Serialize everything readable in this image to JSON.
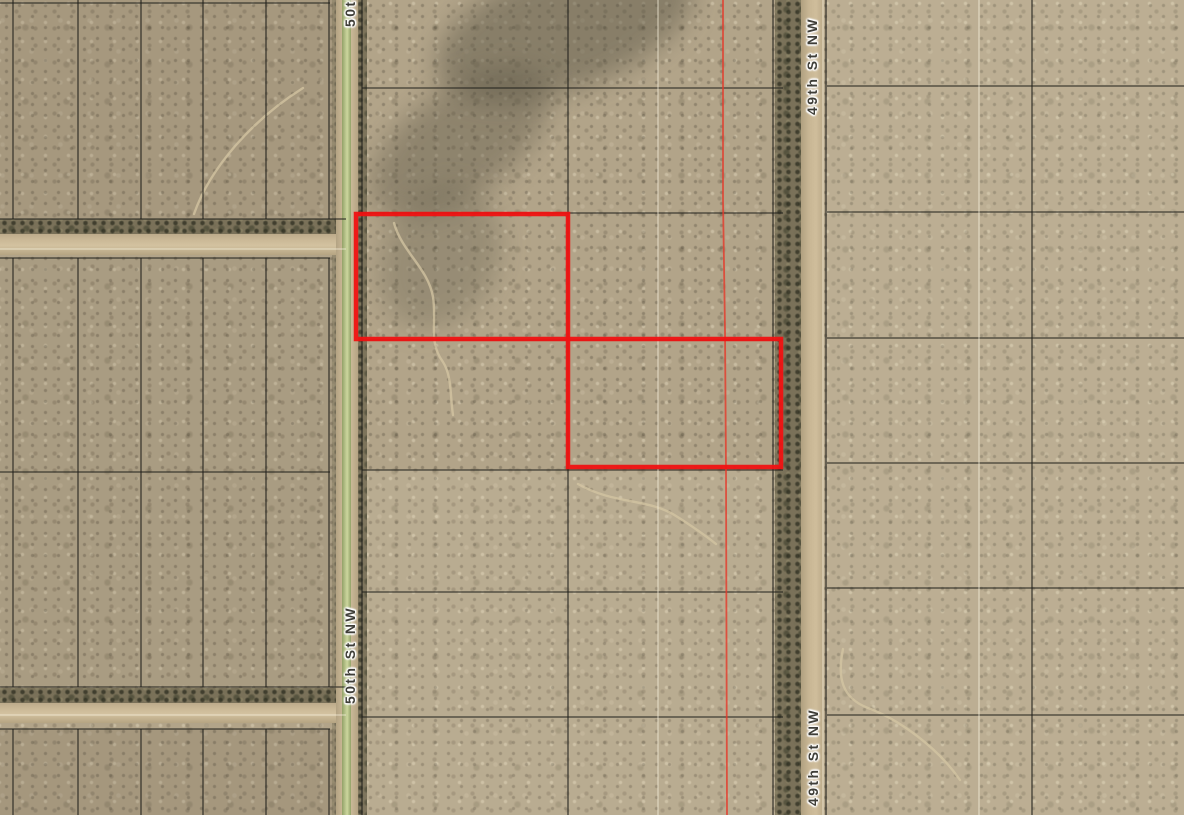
{
  "map": {
    "street_labels": [
      {
        "id": "lbl-50th-top",
        "text": "50th St NW",
        "note": "partially cut off at top edge of view"
      },
      {
        "id": "lbl-50th",
        "text": "50th St NW"
      },
      {
        "id": "lbl-49th-top",
        "text": "49th St NW"
      },
      {
        "id": "lbl-49th-bot",
        "text": "49th St NW"
      }
    ],
    "highlighted_parcels": [
      {
        "id": "parcel-highlight-northwest",
        "x": 356,
        "y": 214,
        "width": 212,
        "height": 125
      },
      {
        "id": "parcel-highlight-southeast",
        "x": 568,
        "y": 339,
        "width": 213,
        "height": 128
      }
    ],
    "colors": {
      "terrain_tan": "#b2a489",
      "road_dirt": "#cfbe9d",
      "street_centerline_green": "#c0cc93",
      "vegetation_dark": "#746c54",
      "parcel_line_black": "#21201c",
      "survey_line_white": "#f6f0dc",
      "highlight_red": "#f01212",
      "section_line_red": "#e5392a",
      "label_text": "#3f3e38"
    },
    "geometry": {
      "black_segments": [
        [
          13,
          0,
          13,
          219
        ],
        [
          78,
          0,
          78,
          219
        ],
        [
          141,
          0,
          141,
          219
        ],
        [
          203,
          0,
          203,
          219
        ],
        [
          266,
          0,
          266,
          219
        ],
        [
          329,
          0,
          329,
          219
        ],
        [
          13,
          258,
          13,
          687
        ],
        [
          78,
          258,
          78,
          687
        ],
        [
          141,
          258,
          141,
          687
        ],
        [
          203,
          258,
          203,
          687
        ],
        [
          266,
          258,
          266,
          687
        ],
        [
          329,
          258,
          329,
          687
        ],
        [
          13,
          729,
          13,
          815
        ],
        [
          78,
          729,
          78,
          815
        ],
        [
          141,
          729,
          141,
          815
        ],
        [
          203,
          729,
          203,
          815
        ],
        [
          266,
          729,
          266,
          815
        ],
        [
          329,
          729,
          329,
          815
        ],
        [
          0,
          3,
          330,
          3
        ],
        [
          0,
          219,
          346,
          219
        ],
        [
          0,
          258,
          330,
          258
        ],
        [
          0,
          472,
          330,
          472
        ],
        [
          0,
          687,
          346,
          687
        ],
        [
          0,
          729,
          330,
          729
        ],
        [
          568,
          0,
          568,
          815
        ],
        [
          362,
          0,
          362,
          815
        ],
        [
          773,
          0,
          773,
          815
        ],
        [
          362,
          88,
          783,
          88
        ],
        [
          362,
          213,
          783,
          213
        ],
        [
          362,
          340,
          783,
          340
        ],
        [
          362,
          470,
          783,
          470
        ],
        [
          362,
          592,
          783,
          592
        ],
        [
          362,
          717,
          783,
          717
        ],
        [
          826,
          0,
          826,
          815
        ],
        [
          1032,
          0,
          1032,
          815
        ],
        [
          827,
          86,
          1184,
          86
        ],
        [
          827,
          212,
          1184,
          212
        ],
        [
          827,
          338,
          1184,
          338
        ],
        [
          827,
          463,
          1184,
          463
        ],
        [
          827,
          588,
          1184,
          588
        ],
        [
          827,
          715,
          1184,
          715
        ]
      ],
      "white_segments": [
        [
          658,
          0,
          658,
          815
        ],
        [
          979,
          0,
          979,
          815
        ],
        [
          823,
          0,
          823,
          815
        ],
        [
          0,
          249,
          346,
          249
        ],
        [
          0,
          715,
          346,
          715
        ]
      ],
      "trails": [
        "M394,223 C402,252 428,268 433,297 C437,322 428,342 443,362 C452,376 450,396 453,415",
        "M578,484 C615,505 648,498 676,516 C695,528 706,536 716,544",
        "M843,649 C837,678 842,698 868,708 C900,720 938,748 960,780",
        "M303,88 C252,120 210,168 194,214"
      ],
      "section_line": "M723,0 L723,200 L725,330 L726,470 L727,815"
    }
  }
}
